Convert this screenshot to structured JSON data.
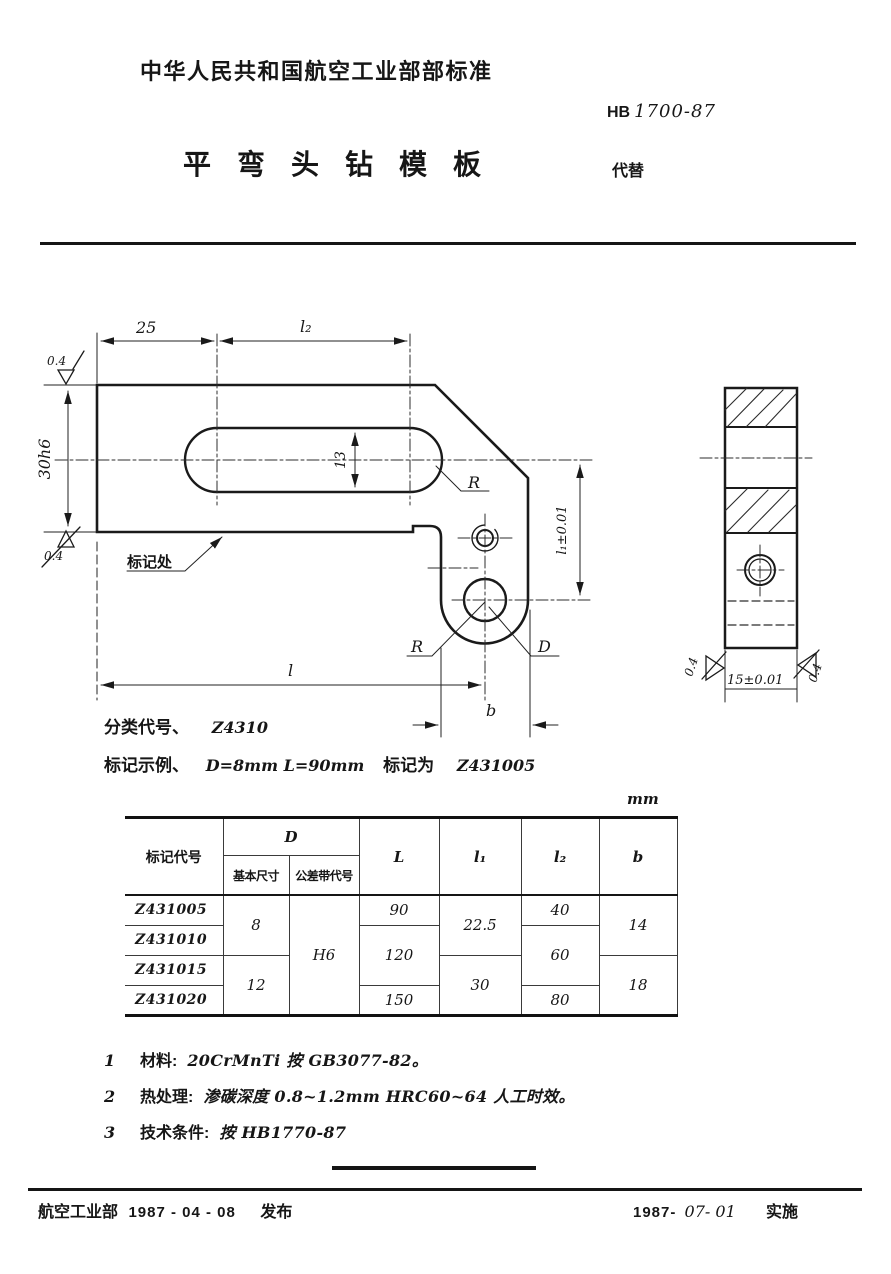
{
  "header": {
    "org": "中华人民共和国航空工业部部标准",
    "code_prefix": "HB",
    "code_number": "1700-87",
    "title": "平弯头钻模板",
    "supersedes": "代替"
  },
  "classification": {
    "label": "分类代号、",
    "value": "Z4310"
  },
  "marking": {
    "label": "标记示例、",
    "example": "D=8mm  L=90mm",
    "mid": "标记为",
    "code": "Z431005"
  },
  "drawing": {
    "dim_top_left": "25",
    "dim_top_right": "l₂",
    "roughness": "0.4",
    "dim_height": "30h6",
    "dim_slot": "13",
    "mark_label": "标记处",
    "radius_label": "R",
    "dia_label": "D",
    "dim_l1": "l₁±0.01",
    "dim_length": "l",
    "dim_b": "b",
    "side_width": "15±0.01"
  },
  "table": {
    "unit": "mm",
    "headers": {
      "code": "标记代号",
      "d": "D",
      "d_basic": "基本尺寸",
      "d_tol": "公差带代号",
      "l": "L",
      "l1": "l₁",
      "l2": "l₂",
      "b": "b"
    },
    "codes": [
      "Z431005",
      "Z431010",
      "Z431015",
      "Z431020"
    ],
    "d_basic": [
      "8",
      "12"
    ],
    "d_tol": "H6",
    "l": [
      "90",
      "120",
      "150"
    ],
    "l1": [
      "22.5",
      "30"
    ],
    "l2": [
      "40",
      "60",
      "80"
    ],
    "b": [
      "14",
      "18"
    ]
  },
  "notes": [
    {
      "num": "1",
      "label": "材料:",
      "value": "20CrMnTi  按 GB3077-82。"
    },
    {
      "num": "2",
      "label": "热处理:",
      "value": "渗碳深度 0.8~1.2mm HRC60~64 人工时效。"
    },
    {
      "num": "3",
      "label": "技术条件:",
      "value": "按 HB1770-87"
    }
  ],
  "footer": {
    "org": "航空工业部",
    "issue_date": "1987 - 04 - 08",
    "issue_label": "发布",
    "impl_date_printed": "1987-",
    "impl_date_hand": "07- 01",
    "impl_label": "实施"
  }
}
